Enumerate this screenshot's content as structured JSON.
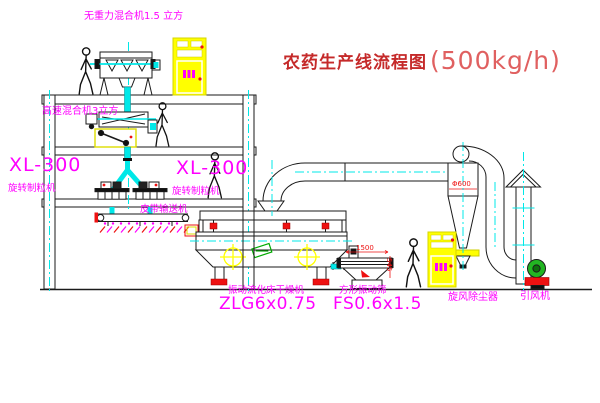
{
  "title": {
    "name": "农药生产线流程图",
    "capacity": "(500kg/h)"
  },
  "labels": {
    "gravity_mixer": "无重力混合机1.5 立方",
    "speed_mixer": "高速混合机3立方",
    "xl_left_model": "XL-300",
    "xl_left_name": "旋转制粒机",
    "xl_center_model": "XL-300",
    "xl_center_name": "旋转制粒机",
    "belt_conveyor": "皮带输送机",
    "dryer_name": "振动流化床干燥机",
    "dryer_model": "ZLG6x0.75",
    "screen_name": "方形振动筛",
    "screen_model": "FS0.6x1.5",
    "cyclone_name": "旋风除尘器",
    "fan_name": "引风机"
  },
  "dimensions": {
    "cyclone_diameter": "Φ600",
    "screen_length": "1500",
    "screen_height": "545"
  },
  "colors": {
    "label_magenta": "#ff00ff",
    "title_red": "#c52a2a",
    "centerline_cyan": "#00e8e8",
    "cabinet_yellow": "#ffff00",
    "accent_red": "#ee1111",
    "fan_green": "#22b522"
  }
}
